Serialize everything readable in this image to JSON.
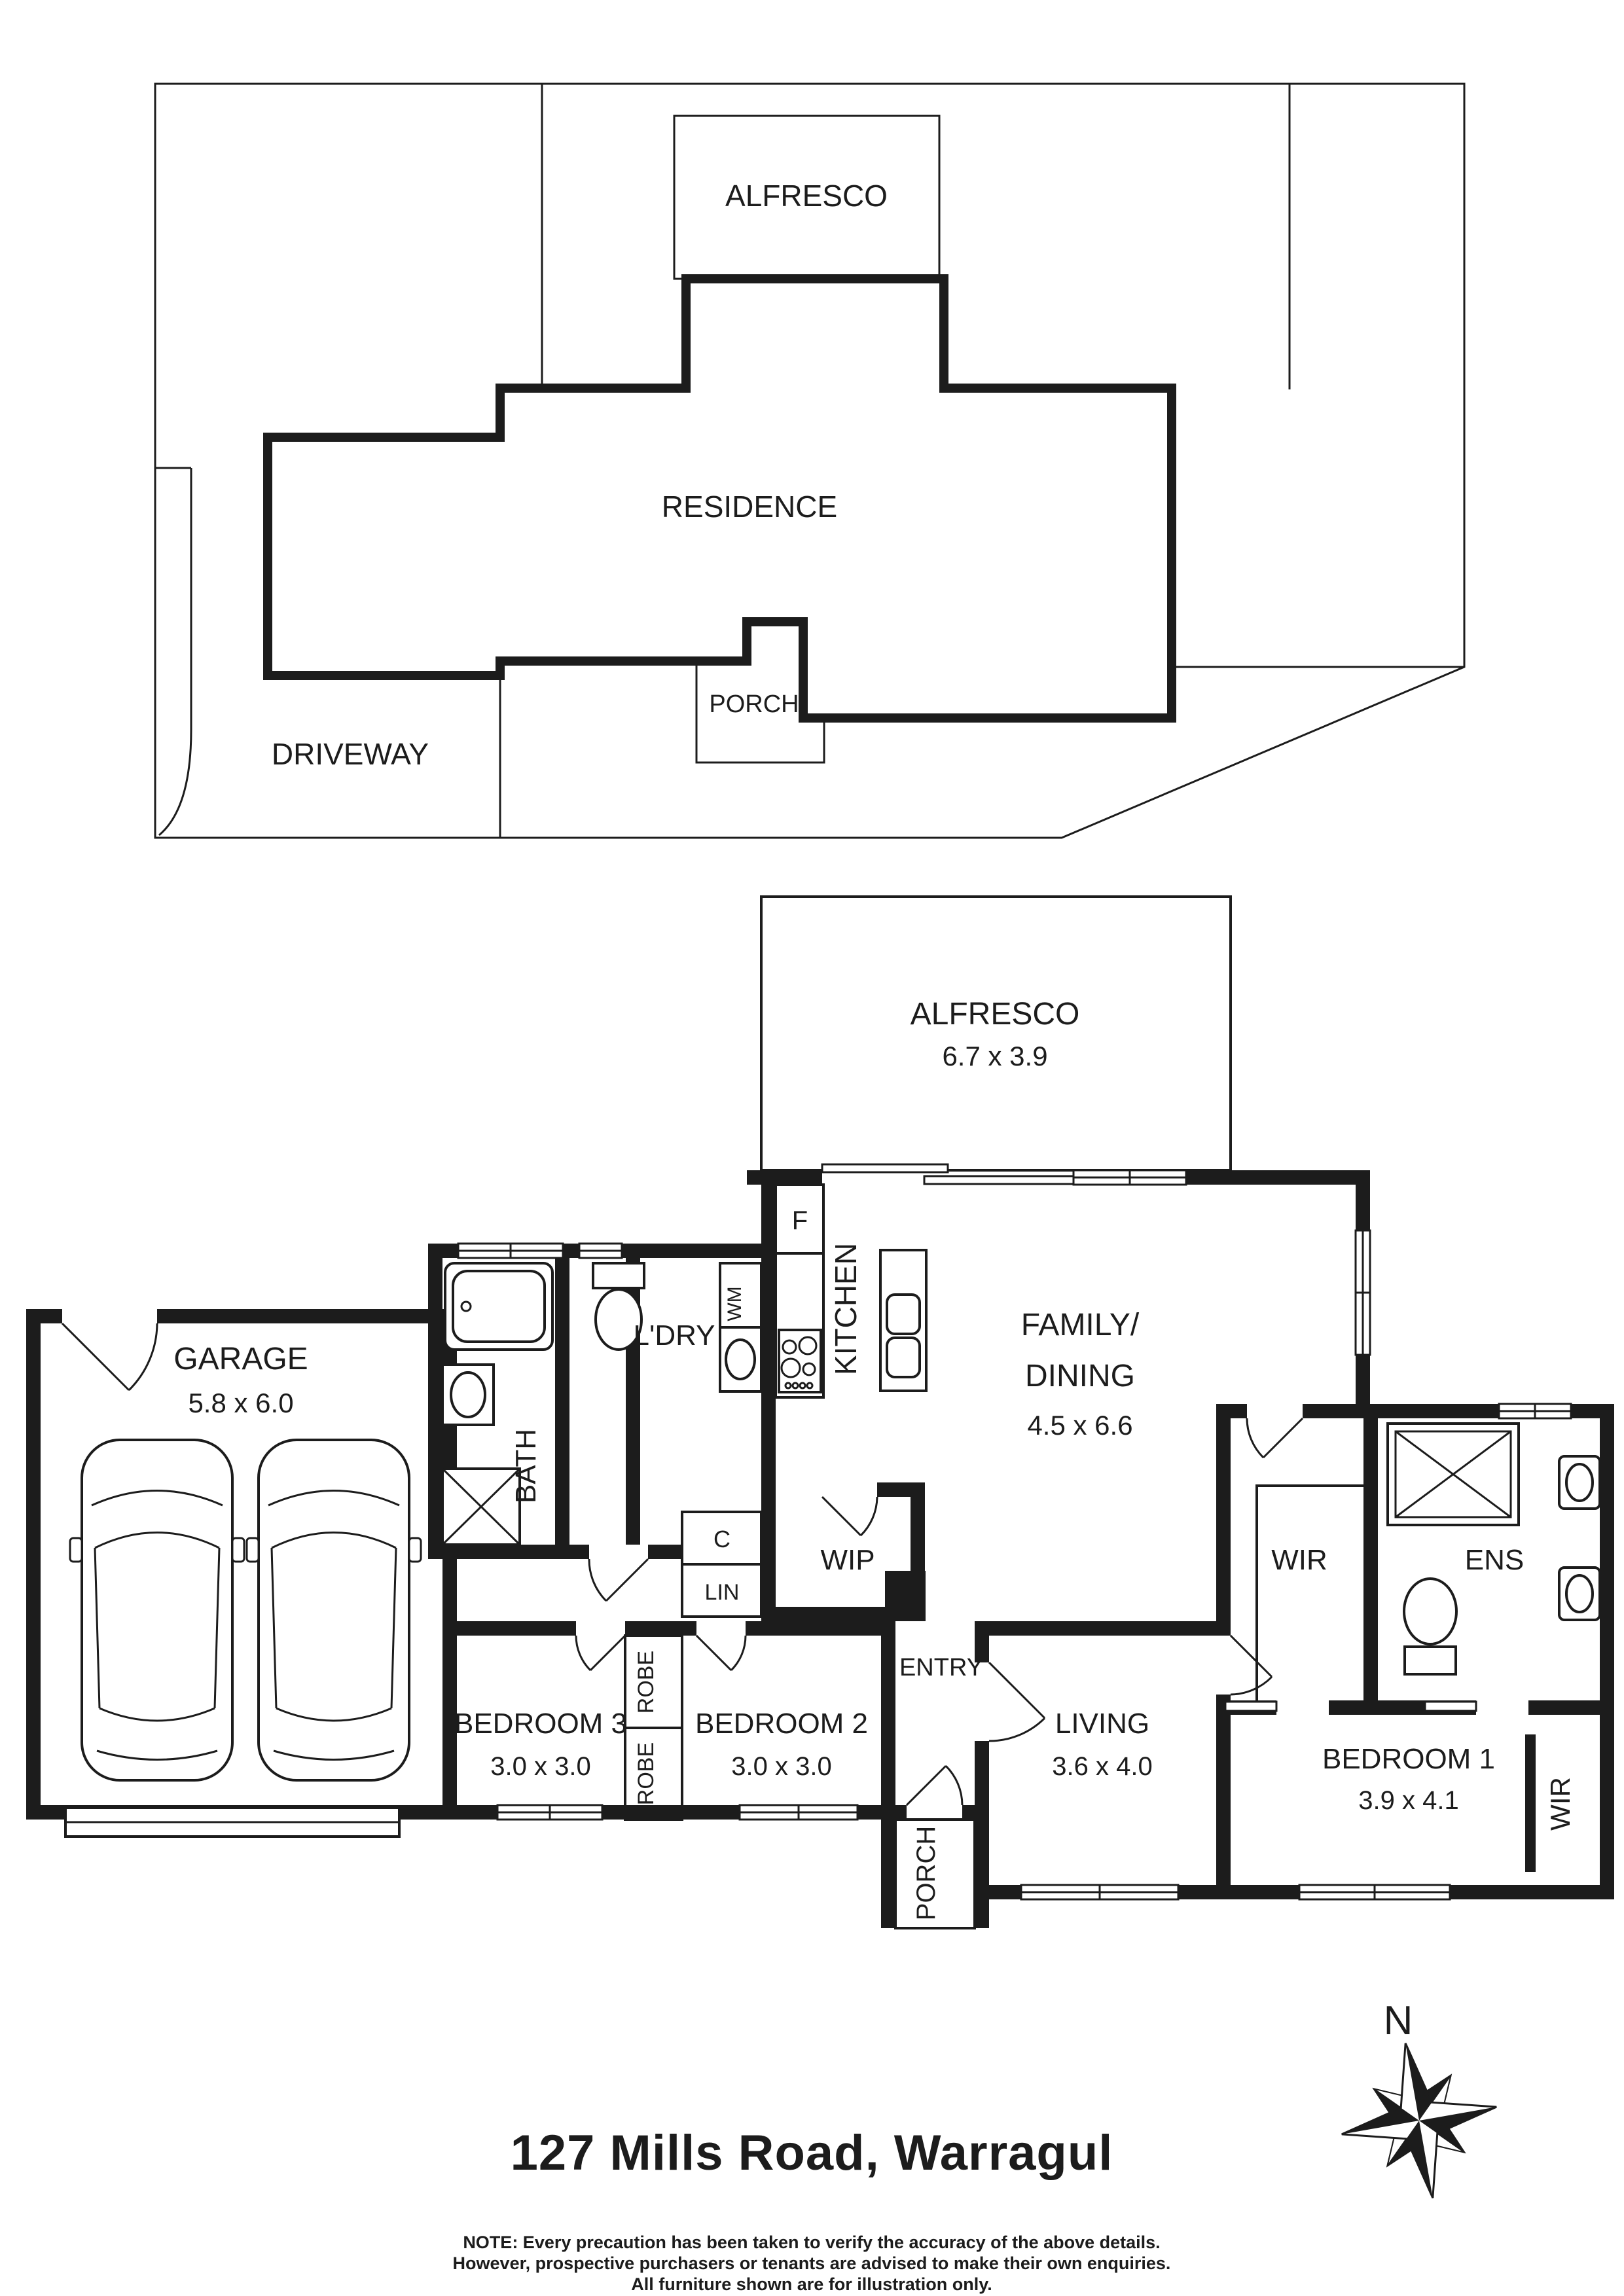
{
  "site_plan": {
    "alfresco": "ALFRESCO",
    "residence": "RESIDENCE",
    "porch": "PORCH",
    "driveway": "DRIVEWAY"
  },
  "floor_plan": {
    "alfresco": {
      "name": "ALFRESCO",
      "dims": "6.7 x 3.9"
    },
    "family": {
      "line1": "FAMILY/",
      "line2": "DINING",
      "dims": "4.5 x 6.6"
    },
    "kitchen": {
      "name": "KITCHEN"
    },
    "fridge": "F",
    "wip": "WIP",
    "laundry": "L'DRY",
    "washing_machine": "WM",
    "cupboard": "C",
    "linen": "LIN",
    "bath": "BATH",
    "garage": {
      "name": "GARAGE",
      "dims": "5.8 x 6.0"
    },
    "bed3": {
      "name": "BEDROOM 3",
      "dims": "3.0 x 3.0"
    },
    "robe": "ROBE",
    "bed2": {
      "name": "BEDROOM 2",
      "dims": "3.0 x 3.0"
    },
    "entry": "ENTRY",
    "living": {
      "name": "LIVING",
      "dims": "3.6 x 4.0"
    },
    "porch": "PORCH",
    "wir": "WIR",
    "ens": "ENS",
    "bed1": {
      "name": "BEDROOM 1",
      "dims": "3.9 x 4.1"
    },
    "bed1_wir": "WIR"
  },
  "footer": {
    "compass_north": "N",
    "address": "127 Mills Road, Warragul",
    "note_line1": "NOTE: Every precaution has been taken to verify the accuracy of the above details.",
    "note_line2": "However, prospective purchasers or tenants are advised to make their own enquiries.",
    "note_line3": "All furniture shown are for illustration only."
  },
  "colors": {
    "ink": "#1c1c1c",
    "paper": "#ffffff"
  }
}
